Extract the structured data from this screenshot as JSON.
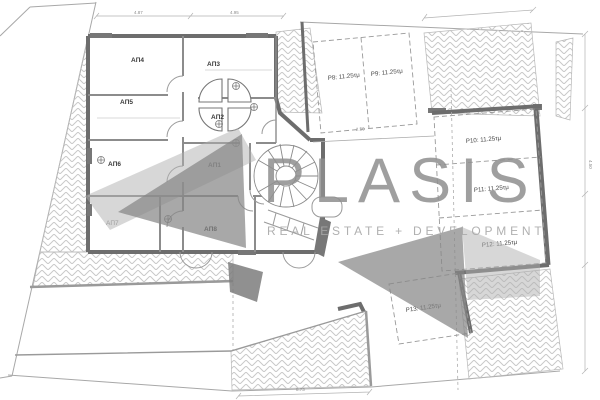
{
  "brand": {
    "name": "PLASIS",
    "tagline": "REAL ESTATE + DEVELOPMENT"
  },
  "rooms": [
    {
      "id": "ap4",
      "label": "ΑΠ4"
    },
    {
      "id": "ap3",
      "label": "ΑΠ3"
    },
    {
      "id": "ap5",
      "label": "ΑΠ5"
    },
    {
      "id": "ap2",
      "label": "ΑΠ2"
    },
    {
      "id": "ap6",
      "label": "ΑΠ6"
    },
    {
      "id": "ap1",
      "label": "ΑΠ1"
    },
    {
      "id": "ap7",
      "label": "ΑΠ7"
    },
    {
      "id": "ap8",
      "label": "ΑΠ8"
    }
  ],
  "parking": [
    {
      "id": "p8",
      "label": "P8: 11.25τμ"
    },
    {
      "id": "p9",
      "label": "P9: 11.25τμ"
    },
    {
      "id": "p10",
      "label": "P10: 11.25τμ"
    },
    {
      "id": "p11",
      "label": "P11: 11.25τμ"
    },
    {
      "id": "p12",
      "label": "P12: 11.25τμ"
    },
    {
      "id": "p13",
      "label": "P13: 11.25τμ"
    }
  ],
  "dimensions": {
    "top_left": "4.87",
    "top_right": "4.95",
    "stalls": "2.50",
    "right": "4.50",
    "bottom": "8.73"
  },
  "colors": {
    "wall": "#6d6d6d",
    "line": "#9a9a9a",
    "hatch": "#c9c9c9",
    "watermark_text": "#8f8f8f",
    "watermark_shape": "#9b9b9b",
    "label": "#3a3a3a"
  }
}
